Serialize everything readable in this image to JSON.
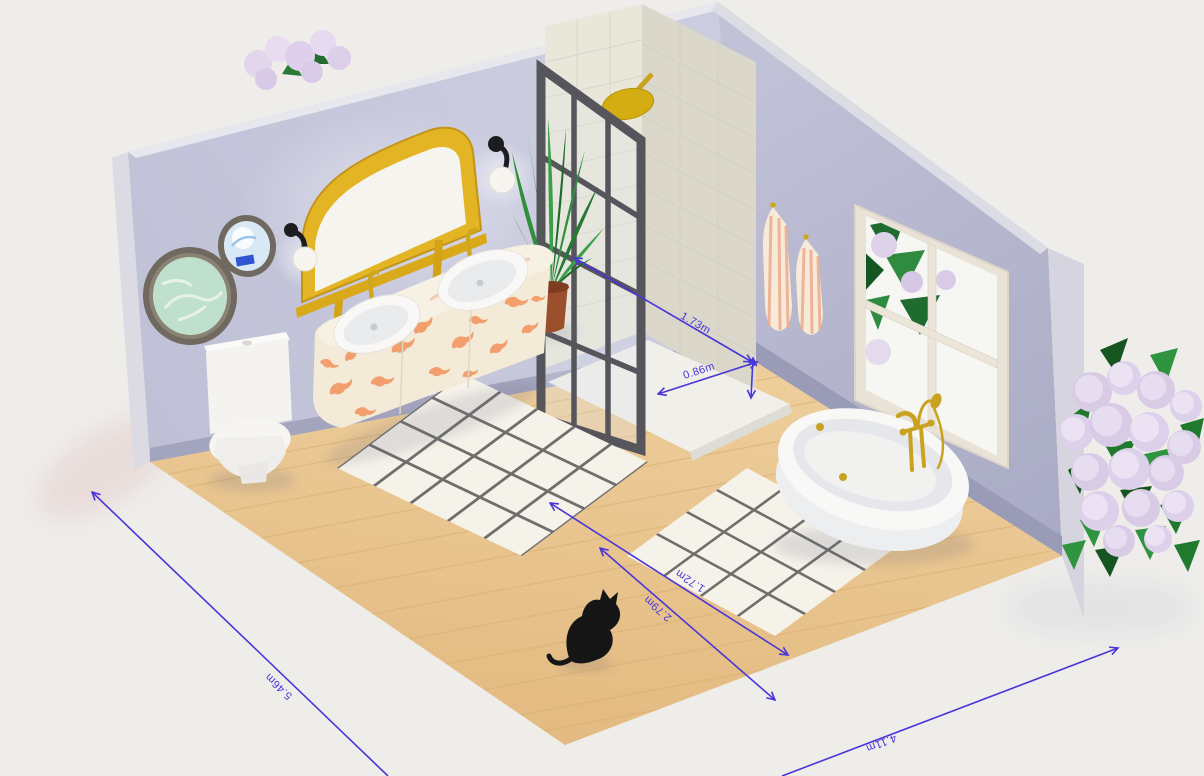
{
  "scene": {
    "name": "isometric-bathroom-3d-render"
  },
  "dimensions": {
    "shower_length": "1.73m",
    "shower_width": "0.86m",
    "rug_width": "1.72m",
    "rug_length": "2.79m",
    "room_length": "5.46m",
    "room_width": "4.11m"
  },
  "colors": {
    "background": "#eeedea",
    "left_wall": "#c5c6db",
    "right_wall": "#b4b5ce",
    "baseboard": "#9fa0ba",
    "floor_wood": "#e9c690",
    "gold_accent": "#ddae1e",
    "dimension_blue": "#4836d8",
    "rug_white": "#f5f2ea",
    "rug_lattice": "#4a4a48",
    "shower_tile": "#e7e4d8",
    "shower_frame": "#56555c",
    "vanity_pattern_orange": "#f29a68",
    "towel_stripe": "#ecab8c",
    "hydrangea_bloom": "#ded2ea",
    "leaf_green": "#1f6b30",
    "cat_black": "#161616"
  },
  "objects": [
    "left-wall",
    "right-wall",
    "wood-floor",
    "toilet",
    "round-wall-art-large",
    "round-wall-art-small",
    "arched-gold-mirror",
    "wall-sconce-left",
    "wall-sconce-right",
    "double-sink-vanity",
    "potted-plant",
    "walk-in-shower",
    "shower-glass-screen",
    "gold-shower-head",
    "towel-left",
    "towel-right",
    "window",
    "clawfoot-bathtub",
    "area-rug-large",
    "area-rug-small",
    "black-cat",
    "hydrangea-bush",
    "hydrangea-over-wall"
  ]
}
